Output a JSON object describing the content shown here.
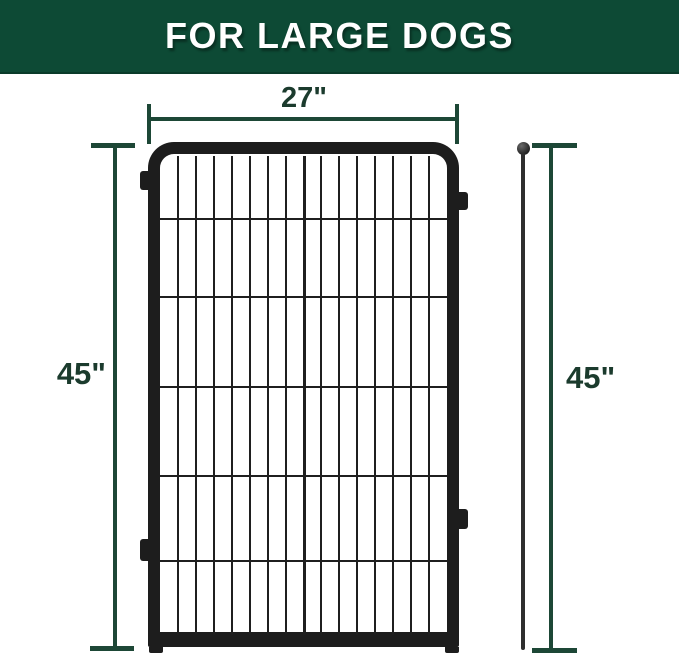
{
  "banner": {
    "title": "FOR LARGE DOGS"
  },
  "diagram": {
    "width_label": "27\"",
    "left_height_label": "45\"",
    "right_height_label": "45\""
  },
  "fence": {
    "columns": 16,
    "center_bar_index": 8,
    "wire_offsets_pct": [
      13.0,
      29.3,
      48.1,
      66.5,
      84.3
    ]
  },
  "colors": {
    "banner_green": "#0d4a35",
    "banner_edge": "#0a3b2a",
    "dim_line_green": "#1d4736",
    "dim_text_green": "#1b3b2d",
    "fence_black": "#1d1d1d",
    "rod_gray": "#2e2e2e",
    "background": "#ffffff"
  }
}
